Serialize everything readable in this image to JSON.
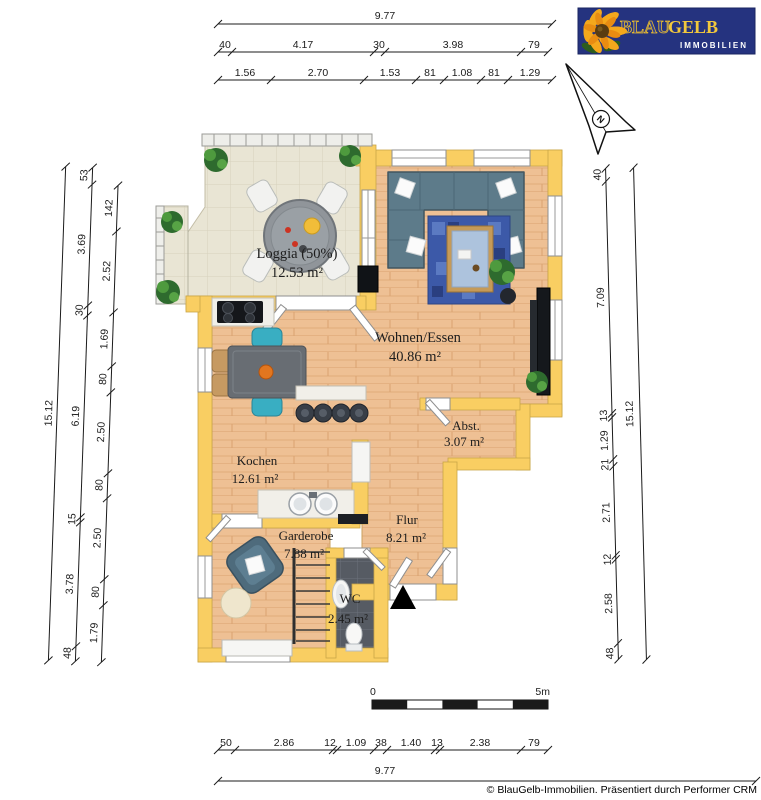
{
  "logo": {
    "blau": "BLAU",
    "gelb": "GELB",
    "tagline": "IMMOBILIEN"
  },
  "compass": {
    "north": "N"
  },
  "rooms": [
    {
      "name": "Loggia (50%)",
      "area": "12.53 m²"
    },
    {
      "name": "Wohnen/Essen",
      "area": "40.86 m²"
    },
    {
      "name": "Abst.",
      "area": "3.07 m²"
    },
    {
      "name": "Kochen",
      "area": "12.61 m²"
    },
    {
      "name": "Flur",
      "area": "8.21 m²"
    },
    {
      "name": "Garderobe",
      "area": "7.88 m²"
    },
    {
      "name": "WC",
      "area": "2.45 m²"
    }
  ],
  "dims": {
    "top_total": "9.77",
    "top_row2": [
      "40",
      "4.17",
      "30",
      "3.98",
      "79"
    ],
    "top_row3": [
      "1.56",
      "2.70",
      "1.53",
      "81",
      "1.08",
      "81",
      "1.29"
    ],
    "bottom_row": [
      "50",
      "2.86",
      "12",
      "1.09",
      "38",
      "1.40",
      "13",
      "2.38",
      "79"
    ],
    "bottom_total": "9.77",
    "left_total": "15.12",
    "left_mid": [
      "53",
      "3.69",
      "30",
      "6.19",
      "15",
      "3.78",
      "48"
    ],
    "left_inner": [
      "142",
      "2.52",
      "1.69",
      "80",
      "2.50",
      "80",
      "2.50",
      "80",
      "1.79"
    ],
    "right_inner": [
      "40",
      "7.09",
      "13",
      "1.29",
      "21",
      "2.71",
      "12",
      "2.58",
      "48"
    ],
    "right_total": "15.12"
  },
  "scale_bar": {
    "zero": "0",
    "five": "5m"
  },
  "footer": {
    "copyright": "© BlauGelb-Immobilien. Präsentiert durch Performer CRM"
  },
  "colors": {
    "wall": "#f9ce62",
    "wood_floor": "#eec094",
    "tile_floor": "#e9e5d4",
    "wc_floor": "#565b63",
    "logo_blue": "#25337f",
    "logo_gold": "#f2c83c"
  }
}
